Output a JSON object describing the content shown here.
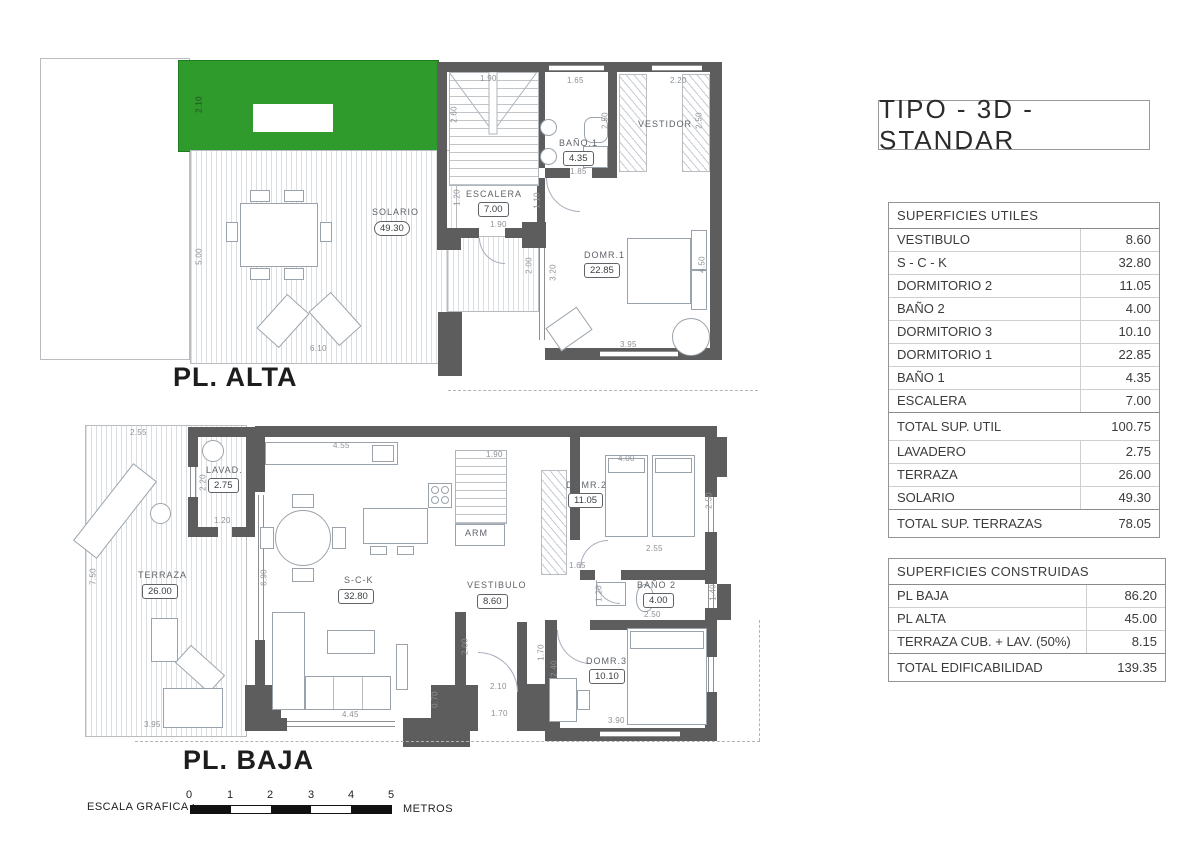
{
  "title": "TIPO - 3D -STANDAR",
  "colors": {
    "grass_green": "#2e9b2c",
    "wall_gray": "#5d5d5d"
  },
  "plan_alta": {
    "label": "PL. ALTA",
    "rooms": {
      "solario": {
        "name": "SOLARIO",
        "area": "49.30"
      },
      "escalera": {
        "name": "ESCALERA",
        "area": "7.00"
      },
      "bano1": {
        "name": "BAÑO.1",
        "area": "4.35"
      },
      "vestidor": {
        "name": "VESTIDOR"
      },
      "dorm1": {
        "name": "DOMR.1",
        "area": "22.85"
      }
    },
    "dims": [
      "1.90",
      "1.65",
      "2.20",
      "2.60",
      "1.20",
      "1.90",
      "1.10",
      "2.50",
      "1.85",
      "2.50",
      "3.95",
      "4.50",
      "3.20",
      "2.00",
      "6.10",
      "5.00",
      "2.10"
    ]
  },
  "plan_baja": {
    "label": "PL. BAJA",
    "rooms": {
      "terraza": {
        "name": "TERRAZA",
        "area": "26.00"
      },
      "lavadero": {
        "name": "LAVAD.",
        "area": "2.75"
      },
      "sck": {
        "name": "S-C-K",
        "area": "32.80"
      },
      "vestibulo": {
        "name": "VESTIBULO",
        "area": "8.60"
      },
      "arm": {
        "name": "ARM"
      },
      "dorm2": {
        "name": "DOMR.2",
        "area": "11.05"
      },
      "bano2": {
        "name": "BAÑO 2",
        "area": "4.00"
      },
      "dorm3": {
        "name": "DOMR.3",
        "area": "10.10"
      }
    },
    "dims": [
      "2.55",
      "2.20",
      "1.20",
      "7.50",
      "3.95",
      "6.90",
      "4.55",
      "1.90",
      "4.00",
      "2.50",
      "1.65",
      "2.55",
      "2.00",
      "0.70",
      "2.10",
      "1.70",
      "1.70",
      "2.40",
      "2.50",
      "3.90",
      "1.20",
      "1.40",
      "4.45"
    ]
  },
  "tables": {
    "utiles": {
      "title": "SUPERFICIES UTILES",
      "rows": [
        {
          "label": "VESTIBULO",
          "value": "8.60"
        },
        {
          "label": "S - C - K",
          "value": "32.80"
        },
        {
          "label": "DORMITORIO 2",
          "value": "11.05"
        },
        {
          "label": "BAÑO 2",
          "value": "4.00"
        },
        {
          "label": "DORMITORIO 3",
          "value": "10.10"
        },
        {
          "label": "DORMITORIO 1",
          "value": "22.85"
        },
        {
          "label": "BAÑO 1",
          "value": "4.35"
        },
        {
          "label": "ESCALERA",
          "value": "7.00"
        },
        {
          "label": "TOTAL SUP. UTIL",
          "value": "100.75",
          "total": true
        },
        {
          "label": "LAVADERO",
          "value": "2.75"
        },
        {
          "label": "TERRAZA",
          "value": "26.00"
        },
        {
          "label": "SOLARIO",
          "value": "49.30"
        },
        {
          "label": "TOTAL SUP. TERRAZAS",
          "value": "78.05",
          "total": true
        }
      ]
    },
    "construidas": {
      "title": "SUPERFICIES CONSTRUIDAS",
      "rows": [
        {
          "label": "PL BAJA",
          "value": "86.20"
        },
        {
          "label": "PL ALTA",
          "value": "45.00"
        },
        {
          "label": "TERRAZA CUB. + LAV. (50%)",
          "value": "8.15"
        },
        {
          "label": "TOTAL EDIFICABILIDAD",
          "value": "139.35",
          "total": true
        }
      ]
    }
  },
  "scale_bar": {
    "label": "ESCALA GRAFICA :",
    "ticks": [
      "0",
      "1",
      "2",
      "3",
      "4",
      "5"
    ],
    "unit": "METROS"
  }
}
